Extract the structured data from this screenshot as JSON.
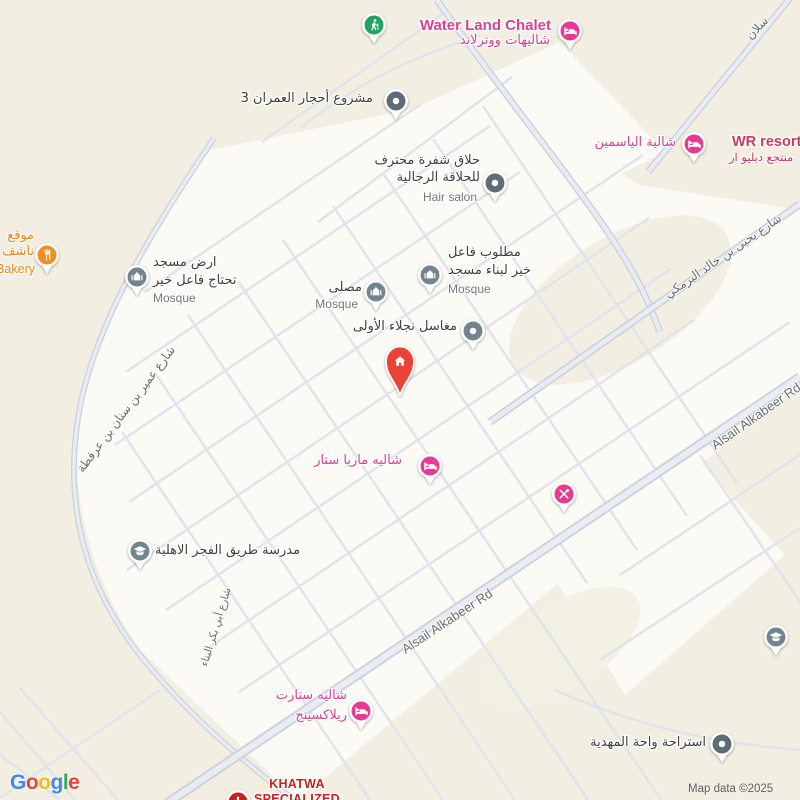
{
  "attribution": "Map data ©2025",
  "logo_letters": [
    "G",
    "o",
    "o",
    "g",
    "l",
    "e"
  ],
  "roads": {
    "alsail": "Alsail Alkabeer Rd",
    "yahya": "شارع يحيى بن خالد البرمكي",
    "umair": "شارع عمير بن سنان بن عرفطة",
    "abi_bakr": "شارع أبي بكر البناء",
    "salan": "سلان"
  },
  "pois": {
    "water_land": {
      "name": "Water Land Chalet",
      "name_ar": "شاليهات ووترلاند"
    },
    "ahjar": {
      "name": "مشروع أحجار العمران 3"
    },
    "hair_salon": {
      "line1": "حلاق شفرة محترف",
      "line2": "للحلاقة الرجالية",
      "category": "Hair salon"
    },
    "yasmin": {
      "name": "شالية الياسمين"
    },
    "wr_resort": {
      "name": "WR resort",
      "name_ar": "منتجع دبليو ار"
    },
    "bakery": {
      "line1": "موقع",
      "line2": "ناشف",
      "category": "Bakery"
    },
    "mosque_land": {
      "line1": "ارض مسجد",
      "line2": "تحتاج فاعل خير",
      "category": "Mosque"
    },
    "musalla": {
      "name": "مصلى",
      "category": "Mosque"
    },
    "mosque_needed": {
      "line1": "مطلوب فاعل",
      "line2": "خير لبناء مسجد",
      "category": "Mosque"
    },
    "maghasil": {
      "name": "مغاسل نجلاء الأولى"
    },
    "maria_star": {
      "name": "شاليه ماريا ستار"
    },
    "school": {
      "name": "مدرسة طريق الفجر الاهلية"
    },
    "start_relaxing": {
      "line1": "شاليه ستارت",
      "line2": "ريلاكسينج"
    },
    "mahdia": {
      "name": "استراحة واحة المهدية"
    },
    "khatwa": {
      "line1": "KHATWA",
      "line2": "SPECIALIZED"
    }
  },
  "colors": {
    "bg": "#f2efe2",
    "block": "#fbfaf5",
    "road-minor": "#dee3ec",
    "road-casing": "#ccd3de",
    "road-fill": "#e9ecf2",
    "pin-pink": "#e83a93",
    "pin-green": "#23a35f",
    "pin-orange": "#ef9021",
    "pin-slate": "#5d6c77",
    "pin-slate-light": "#72858f",
    "pin-red": "#ea4335",
    "pin-dark-red": "#c5221f",
    "label-dark": "#3d4245",
    "label-gray": "#73777c",
    "label-pink": "#d64291",
    "label-orange": "#e8821e",
    "label-red": "#c5221f",
    "label-wr": "#c43a63",
    "road-label": "#6a7077",
    "attribution": "#5f6368",
    "g-blue": "#4285F4",
    "g-red": "#EA4335",
    "g-yellow": "#FBBC05",
    "g-green": "#34A853"
  }
}
